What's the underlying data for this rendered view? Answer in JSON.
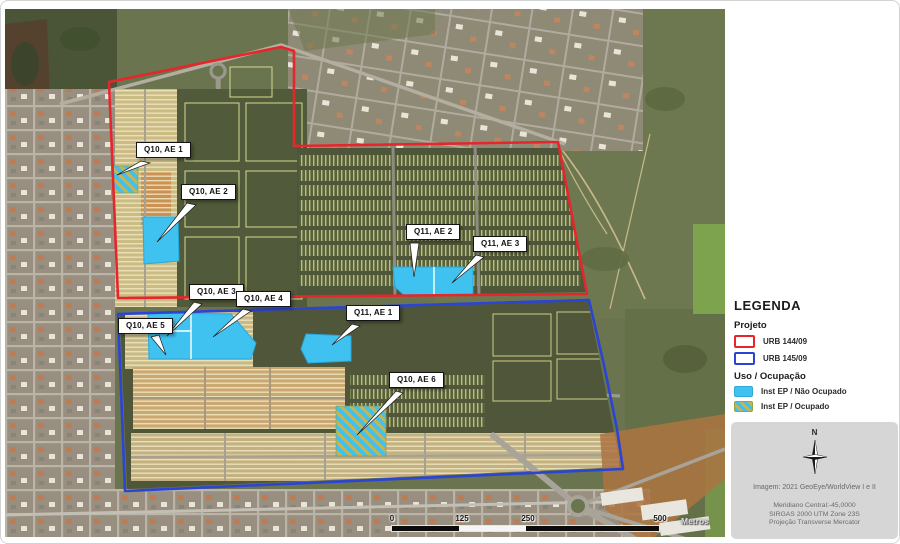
{
  "map": {
    "annotations": [
      {
        "id": "q10-ae1",
        "text": "Q10, AE 1"
      },
      {
        "id": "q10-ae2",
        "text": "Q10, AE 2"
      },
      {
        "id": "q11-ae2",
        "text": "Q11, AE 2"
      },
      {
        "id": "q11-ae3",
        "text": "Q11, AE 3"
      },
      {
        "id": "q10-ae3",
        "text": "Q10, AE 3"
      },
      {
        "id": "q10-ae4",
        "text": "Q10, AE 4"
      },
      {
        "id": "q10-ae5",
        "text": "Q10, AE 5"
      },
      {
        "id": "q11-ae1",
        "text": "Q11, AE 1"
      },
      {
        "id": "q10-ae6",
        "text": "Q10, AE 6"
      }
    ],
    "scalebar": {
      "ticks": [
        "0",
        "125",
        "250",
        "500"
      ],
      "unit": "Metros"
    }
  },
  "legend": {
    "title": "LEGENDA",
    "projeto_heading": "Projeto",
    "projeto_items": [
      {
        "label": "URB 144/09",
        "color": "#E5262B"
      },
      {
        "label": "URB 145/09",
        "color": "#2B44D4"
      }
    ],
    "uso_heading": "Uso / Ocupação",
    "uso_items": [
      {
        "label": "Inst EP / Não Ocupado",
        "fill": "#3FC2F0"
      },
      {
        "label": "Inst EP / Ocupado",
        "fill": "#3FC2F0",
        "stripe": "#C9B44E"
      }
    ]
  },
  "info_panel": {
    "north_label": "N",
    "imagery_credit": "Imagem: 2021 GeoEye/WorldView I e II",
    "projection_lines": [
      "Meridiano Central:-45,0000",
      "SIRGAS 2000 UTM Zone 23S",
      "Projeção Transverse Mercator"
    ]
  }
}
